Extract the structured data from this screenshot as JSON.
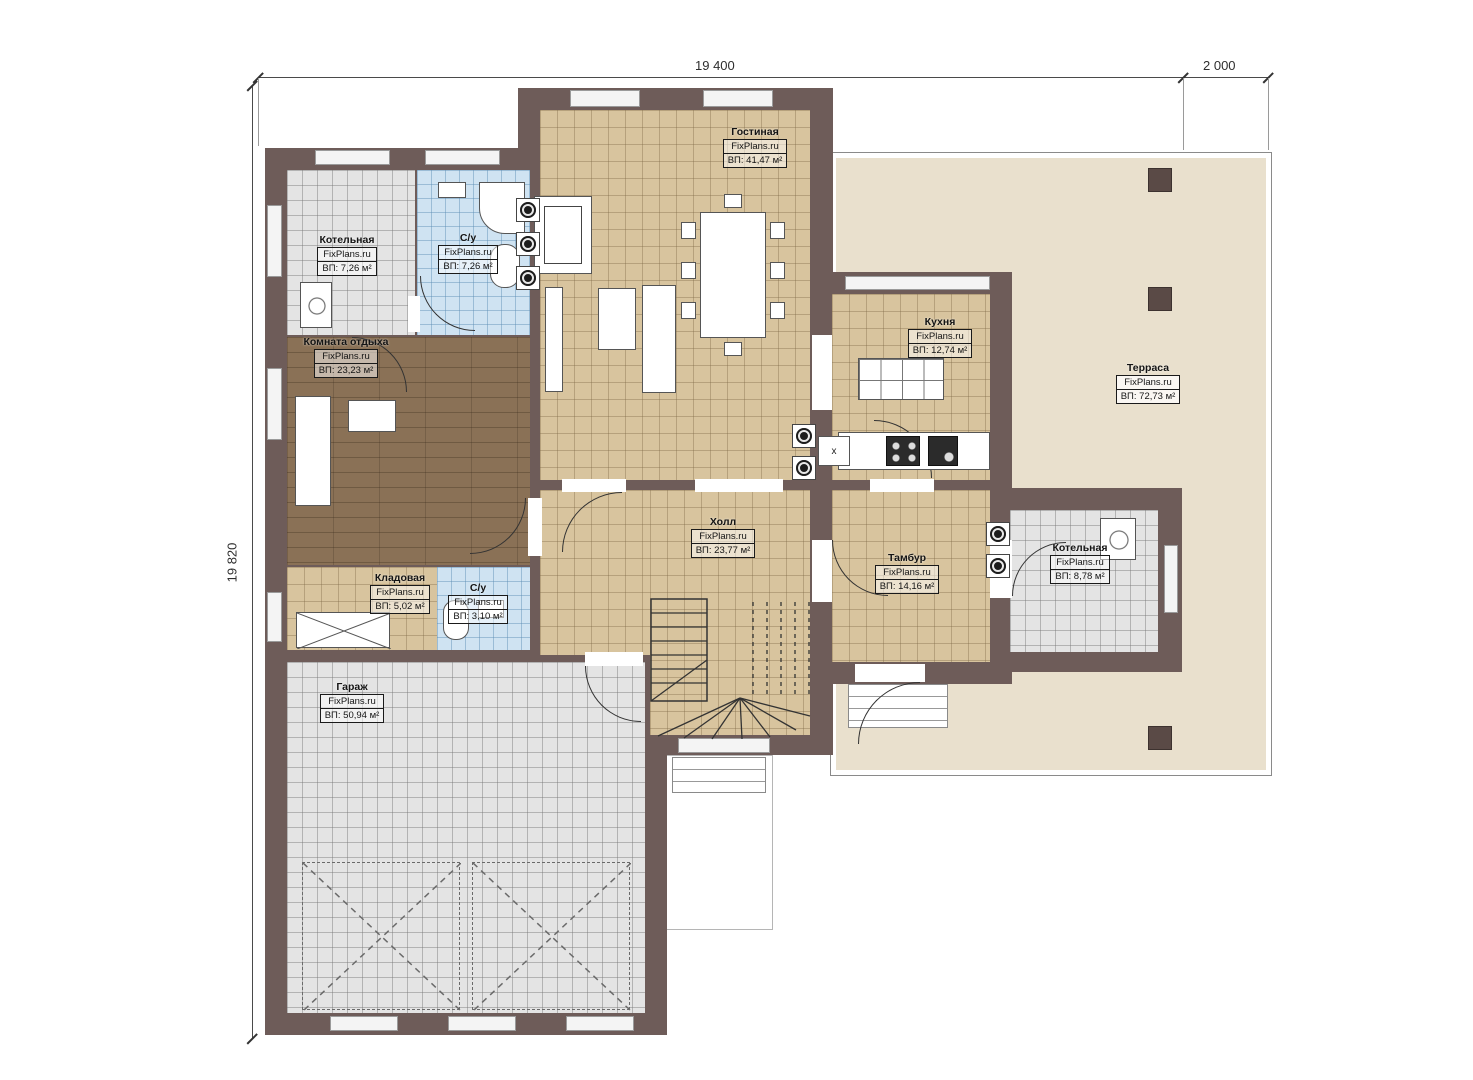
{
  "brand": "FixPlans.ru",
  "dimensions": {
    "top_main": "19 400",
    "top_right": "2 000",
    "left_side": "19 820"
  },
  "rooms": {
    "living": {
      "name": "Гостиная",
      "area": "ВП: 41,47 м²"
    },
    "boiler_top": {
      "name": "Котельная",
      "area": "ВП: 7,26 м²"
    },
    "bath_top": {
      "name": "С/у",
      "area": "ВП: 7,26 м²"
    },
    "lounge": {
      "name": "Комната отдыха",
      "area": "ВП: 23,23 м²"
    },
    "kitchen": {
      "name": "Кухня",
      "area": "ВП: 12,74 м²"
    },
    "terrace": {
      "name": "Терраса",
      "area": "ВП: 72,73 м²"
    },
    "hall": {
      "name": "Холл",
      "area": "ВП: 23,77 м²"
    },
    "tambour": {
      "name": "Тамбур",
      "area": "ВП: 14,16 м²"
    },
    "boiler_right": {
      "name": "Котельная",
      "area": "ВП: 8,78 м²"
    },
    "pantry": {
      "name": "Кладовая",
      "area": "ВП: 5,02 м²"
    },
    "bath_small": {
      "name": "С/у",
      "area": "ВП: 3,10 м²"
    },
    "garage": {
      "name": "Гараж",
      "area": "ВП: 50,94 м²"
    }
  },
  "marks": {
    "kitchen_cabinet": "x"
  },
  "colors": {
    "wall": "#6e5c59",
    "tile_beige": "#d8c49e",
    "tile_gray": "#e4e4e4",
    "tile_blue": "#cfe3f2",
    "wood": "#8a7156",
    "terrace": "#e9e0cd"
  }
}
